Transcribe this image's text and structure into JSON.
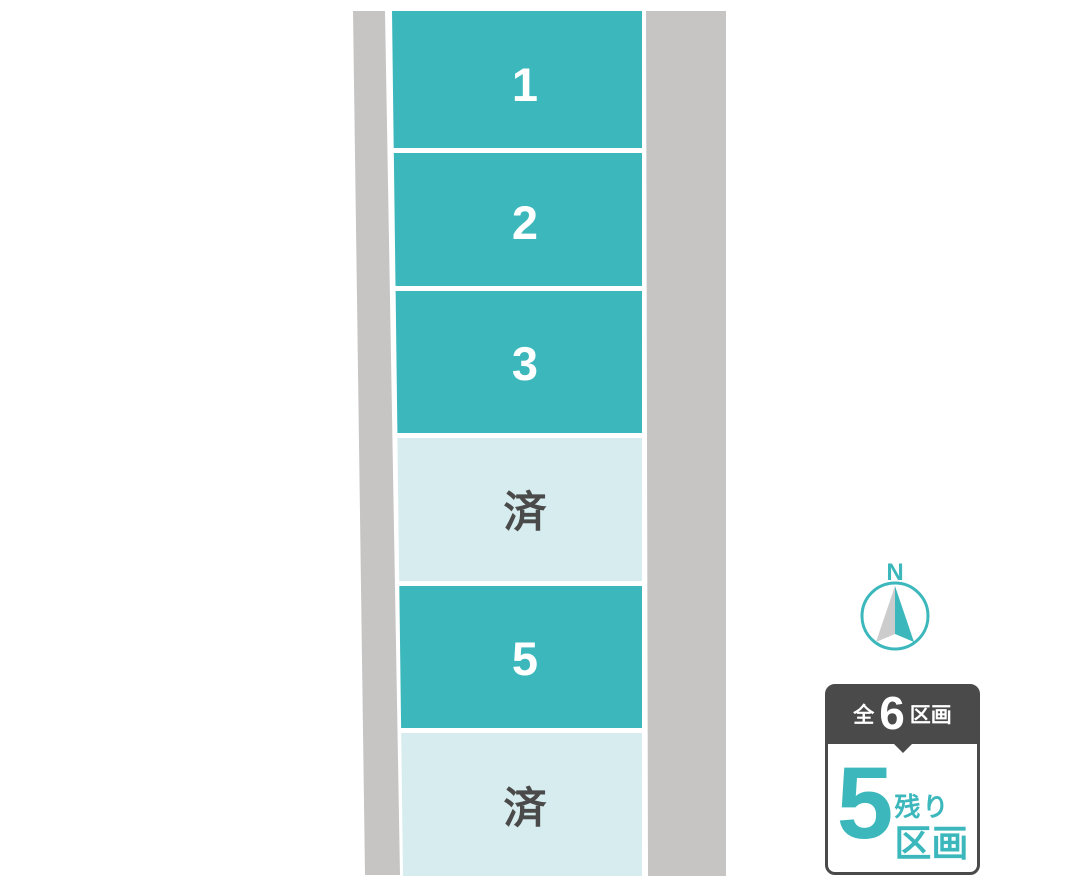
{
  "colors": {
    "page_bg": "#ffffff",
    "teal": "#3cb8bc",
    "light_teal": "#d6ecee",
    "road_gray": "#c7c5c3",
    "dark_gray": "#4a4a4a",
    "sold_text": "#4a4a4a",
    "plot_number_text": "#ffffff",
    "compass_gray": "#cccccc"
  },
  "plots": [
    {
      "label": "1",
      "status": "available",
      "fill": "#3cb8bc",
      "text_color": "#ffffff"
    },
    {
      "label": "2",
      "status": "available",
      "fill": "#3cb8bc",
      "text_color": "#ffffff"
    },
    {
      "label": "3",
      "status": "available",
      "fill": "#3cb8bc",
      "text_color": "#ffffff"
    },
    {
      "label": "済",
      "status": "sold",
      "fill": "#d6ecee",
      "text_color": "#4a4a4a"
    },
    {
      "label": "5",
      "status": "available",
      "fill": "#3cb8bc",
      "text_color": "#ffffff"
    },
    {
      "label": "済",
      "status": "sold",
      "fill": "#d6ecee",
      "text_color": "#4a4a4a"
    }
  ],
  "compass": {
    "label": "N"
  },
  "badge": {
    "total_prefix": "全",
    "total_count": "6",
    "total_suffix": "区画",
    "remaining_count": "5",
    "remaining_label_top": "残り",
    "remaining_label_bottom": "区画"
  }
}
